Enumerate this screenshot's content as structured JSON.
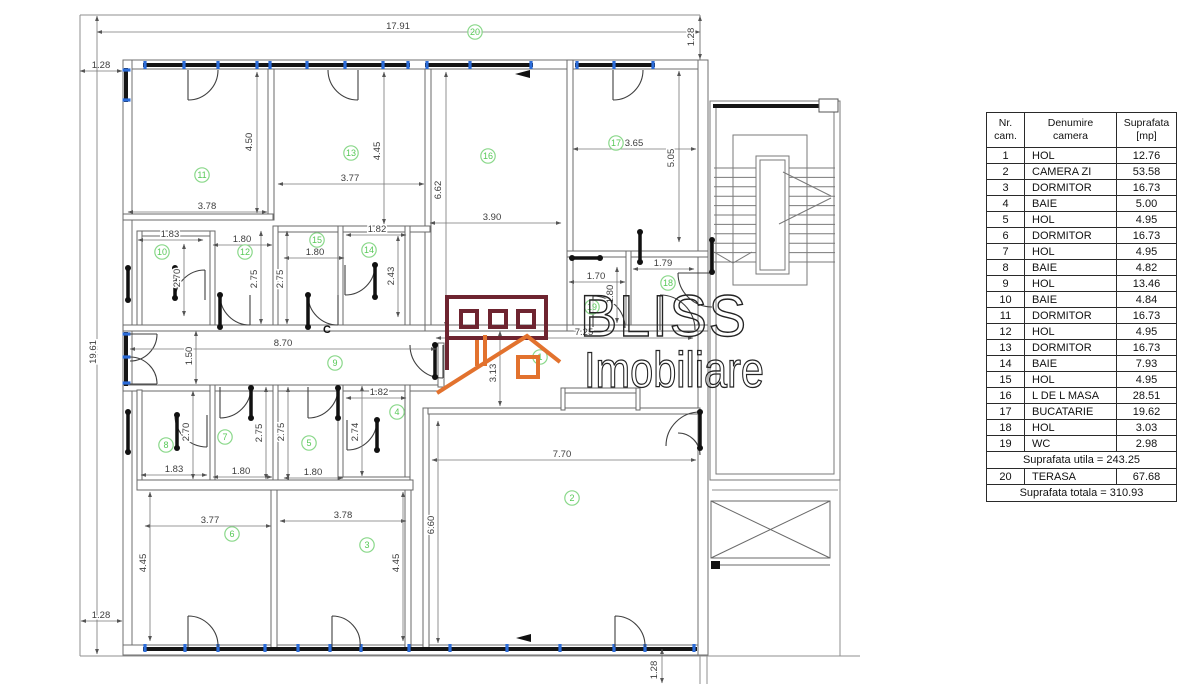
{
  "logo": {
    "title": "BLISS",
    "subtitle": "Imobiliare",
    "maroon": "#6e2430",
    "orange": "#e2722e",
    "text_color": "#242424"
  },
  "annotations": {
    "section_label": "C"
  },
  "colors": {
    "dim_text": "#3d3d3d",
    "marker_green": "#57c957",
    "window_blue": "#2b6cd9",
    "wall": "#6f6f6f"
  },
  "table": {
    "headers": [
      "Nr.\ncam.",
      "Denumire\ncamera",
      "Suprafata\n[mp]"
    ],
    "rows": [
      [
        "1",
        "HOL",
        "12.76"
      ],
      [
        "2",
        "CAMERA ZI",
        "53.58"
      ],
      [
        "3",
        "DORMITOR",
        "16.73"
      ],
      [
        "4",
        "BAIE",
        "5.00"
      ],
      [
        "5",
        "HOL",
        "4.95"
      ],
      [
        "6",
        "DORMITOR",
        "16.73"
      ],
      [
        "7",
        "HOL",
        "4.95"
      ],
      [
        "8",
        "BAIE",
        "4.82"
      ],
      [
        "9",
        "HOL",
        "13.46"
      ],
      [
        "10",
        "BAIE",
        "4.84"
      ],
      [
        "11",
        "DORMITOR",
        "16.73"
      ],
      [
        "12",
        "HOL",
        "4.95"
      ],
      [
        "13",
        "DORMITOR",
        "16.73"
      ],
      [
        "14",
        "BAIE",
        "7.93"
      ],
      [
        "15",
        "HOL",
        "4.95"
      ],
      [
        "16",
        "L DE L MASA",
        "28.51"
      ],
      [
        "17",
        "BUCATARIE",
        "19.62"
      ],
      [
        "18",
        "HOL",
        "3.03"
      ],
      [
        "19",
        "WC",
        "2.98"
      ]
    ],
    "subtotal": "Suprafata utila = 243.25",
    "terrace_row": [
      "20",
      "TERASA",
      "67.68"
    ],
    "total": "Suprafata totala = 310.93"
  },
  "plan": {
    "markers": [
      {
        "n": "20",
        "x": 475,
        "y": 32
      },
      {
        "n": "11",
        "x": 202,
        "y": 175
      },
      {
        "n": "13",
        "x": 351,
        "y": 153
      },
      {
        "n": "16",
        "x": 488,
        "y": 156
      },
      {
        "n": "17",
        "x": 616,
        "y": 143
      },
      {
        "n": "10",
        "x": 162,
        "y": 252
      },
      {
        "n": "12",
        "x": 245,
        "y": 252
      },
      {
        "n": "15",
        "x": 317,
        "y": 240
      },
      {
        "n": "14",
        "x": 369,
        "y": 250
      },
      {
        "n": "9",
        "x": 335,
        "y": 363
      },
      {
        "n": "1",
        "x": 540,
        "y": 357
      },
      {
        "n": "19",
        "x": 592,
        "y": 307
      },
      {
        "n": "18",
        "x": 668,
        "y": 283
      },
      {
        "n": "8",
        "x": 166,
        "y": 445
      },
      {
        "n": "7",
        "x": 225,
        "y": 437
      },
      {
        "n": "5",
        "x": 309,
        "y": 443
      },
      {
        "n": "4",
        "x": 397,
        "y": 412
      },
      {
        "n": "6",
        "x": 232,
        "y": 534
      },
      {
        "n": "3",
        "x": 367,
        "y": 545
      },
      {
        "n": "2",
        "x": 572,
        "y": 498
      }
    ],
    "dimensions": [
      {
        "t": "17.91",
        "x": 398,
        "y": 29,
        "r": 0,
        "l": [
          97,
          32,
          700,
          32
        ]
      },
      {
        "t": "1.28",
        "x": 694,
        "y": 37,
        "r": 1,
        "l": [
          700,
          16,
          700,
          59
        ]
      },
      {
        "t": "1.28",
        "x": 101,
        "y": 68,
        "r": 0,
        "l": [
          80,
          71,
          122,
          71
        ]
      },
      {
        "t": "19.61",
        "x": 96,
        "y": 352,
        "r": 1,
        "l": [
          97,
          16,
          97,
          654
        ]
      },
      {
        "t": "1.28",
        "x": 101,
        "y": 618,
        "r": 0,
        "l": [
          81,
          621,
          122,
          621
        ]
      },
      {
        "t": "4.50",
        "x": 252,
        "y": 142,
        "r": 1,
        "l": [
          257,
          72,
          257,
          213
        ]
      },
      {
        "t": "3.78",
        "x": 207,
        "y": 209,
        "r": 0,
        "l": [
          128,
          212,
          267,
          212
        ]
      },
      {
        "t": "4.45",
        "x": 380,
        "y": 151,
        "r": 1,
        "l": [
          384,
          72,
          384,
          224
        ]
      },
      {
        "t": "3.77",
        "x": 350,
        "y": 181,
        "r": 0,
        "l": [
          278,
          184,
          424,
          184
        ]
      },
      {
        "t": "6.62",
        "x": 441,
        "y": 190,
        "r": 1,
        "l": [
          446,
          72,
          446,
          327
        ]
      },
      {
        "t": "3.90",
        "x": 492,
        "y": 220,
        "r": 0,
        "l": [
          430,
          223,
          561,
          223
        ]
      },
      {
        "t": "3.65",
        "x": 634,
        "y": 146,
        "r": 0,
        "l": [
          573,
          149,
          696,
          149
        ]
      },
      {
        "t": "5.05",
        "x": 674,
        "y": 158,
        "r": 1,
        "l": [
          679,
          71,
          679,
          242
        ]
      },
      {
        "t": "1.83",
        "x": 170,
        "y": 237,
        "r": 0,
        "l": [
          138,
          240,
          203,
          240
        ]
      },
      {
        "t": "2.70",
        "x": 180,
        "y": 278,
        "r": 1,
        "l": [
          184,
          244,
          184,
          316
        ]
      },
      {
        "t": "1.80",
        "x": 242,
        "y": 242,
        "r": 0,
        "l": [
          213,
          245,
          272,
          245
        ]
      },
      {
        "t": "2.75",
        "x": 257,
        "y": 279,
        "r": 1,
        "l": [
          261,
          231,
          261,
          324
        ]
      },
      {
        "t": "1.80",
        "x": 315,
        "y": 255,
        "r": 0,
        "l": [
          284,
          258,
          344,
          258
        ]
      },
      {
        "t": "2.75",
        "x": 283,
        "y": 279,
        "r": 1,
        "l": [
          287,
          231,
          287,
          324
        ]
      },
      {
        "t": "1.82",
        "x": 377,
        "y": 232,
        "r": 0,
        "l": [
          346,
          235,
          406,
          235
        ]
      },
      {
        "t": "2.43",
        "x": 394,
        "y": 276,
        "r": 1,
        "l": [
          398,
          236,
          398,
          317
        ]
      },
      {
        "t": "1.70",
        "x": 596,
        "y": 279,
        "r": 0,
        "l": [
          569,
          282,
          625,
          282
        ]
      },
      {
        "t": "1.79",
        "x": 663,
        "y": 266,
        "r": 0,
        "l": [
          633,
          269,
          694,
          269
        ]
      },
      {
        "t": "1.80",
        "x": 613,
        "y": 294,
        "r": 1,
        "l": [
          617,
          267,
          617,
          323
        ]
      },
      {
        "t": "8.70",
        "x": 283,
        "y": 346,
        "r": 0,
        "l": [
          130,
          349,
          436,
          349
        ]
      },
      {
        "t": "1.50",
        "x": 192,
        "y": 356,
        "r": 1,
        "l": [
          196,
          331,
          196,
          384
        ]
      },
      {
        "t": "7.25",
        "x": 584,
        "y": 335,
        "r": 0,
        "l": [
          436,
          338,
          693,
          338
        ]
      },
      {
        "t": "3.13",
        "x": 496,
        "y": 373,
        "r": 1,
        "l": [
          500,
          331,
          500,
          406
        ]
      },
      {
        "t": "1.83",
        "x": 174,
        "y": 472,
        "r": 0,
        "l": [
          141,
          475,
          207,
          475
        ]
      },
      {
        "t": "2.70",
        "x": 189,
        "y": 432,
        "r": 1,
        "l": [
          193,
          391,
          193,
          479
        ]
      },
      {
        "t": "1.80",
        "x": 241,
        "y": 474,
        "r": 0,
        "l": [
          213,
          477,
          272,
          477
        ]
      },
      {
        "t": "2.75",
        "x": 262,
        "y": 433,
        "r": 1,
        "l": [
          266,
          387,
          266,
          479
        ]
      },
      {
        "t": "1.80",
        "x": 313,
        "y": 475,
        "r": 0,
        "l": [
          284,
          478,
          343,
          478
        ]
      },
      {
        "t": "2.75",
        "x": 284,
        "y": 432,
        "r": 1,
        "l": [
          288,
          387,
          288,
          479
        ]
      },
      {
        "t": "1.82",
        "x": 379,
        "y": 395,
        "r": 0,
        "l": [
          346,
          398,
          406,
          398
        ]
      },
      {
        "t": "2.74",
        "x": 358,
        "y": 432,
        "r": 1,
        "l": [
          362,
          386,
          362,
          476
        ]
      },
      {
        "t": "3.77",
        "x": 210,
        "y": 523,
        "r": 0,
        "l": [
          145,
          526,
          271,
          526
        ]
      },
      {
        "t": "4.45",
        "x": 146,
        "y": 563,
        "r": 1,
        "l": [
          150,
          492,
          150,
          641
        ]
      },
      {
        "t": "3.78",
        "x": 343,
        "y": 518,
        "r": 0,
        "l": [
          280,
          521,
          406,
          521
        ]
      },
      {
        "t": "4.45",
        "x": 399,
        "y": 563,
        "r": 1,
        "l": [
          403,
          492,
          403,
          641
        ]
      },
      {
        "t": "6.60",
        "x": 434,
        "y": 525,
        "r": 1,
        "l": [
          438,
          421,
          438,
          643
        ]
      },
      {
        "t": "7.70",
        "x": 562,
        "y": 457,
        "r": 0,
        "l": [
          432,
          460,
          696,
          460
        ]
      },
      {
        "t": "1.28",
        "x": 657,
        "y": 670,
        "r": 1,
        "l": [
          662,
          649,
          662,
          683
        ]
      }
    ]
  }
}
